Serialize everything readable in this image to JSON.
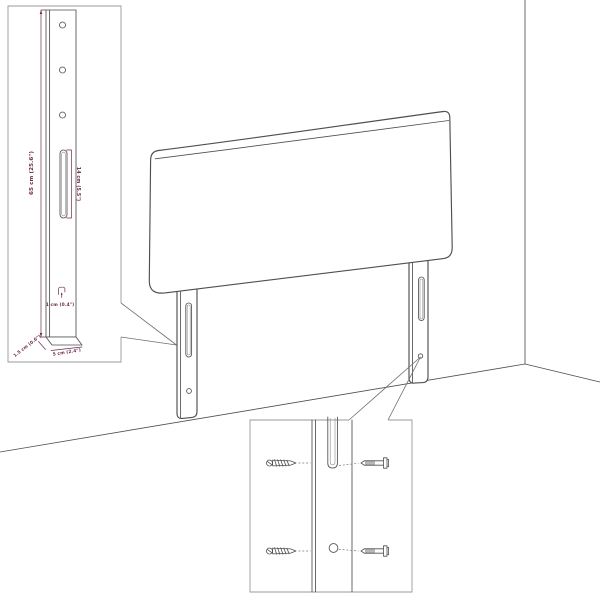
{
  "colors": {
    "drawing_line": "#4f4f4f",
    "dimension_annotation": "#6e2b4b",
    "inset_border": "#9a9a9a",
    "background": "#ffffff"
  },
  "leg_detail_inset": {
    "height_label": "65 cm (25.6\")",
    "slot_length_label": "14 cm (5.5\")",
    "slot_width_label": "1 cm (0.4\")",
    "depth_label": "1.5 cm (0.6\")",
    "width_label": "5 cm (2.4\")"
  }
}
